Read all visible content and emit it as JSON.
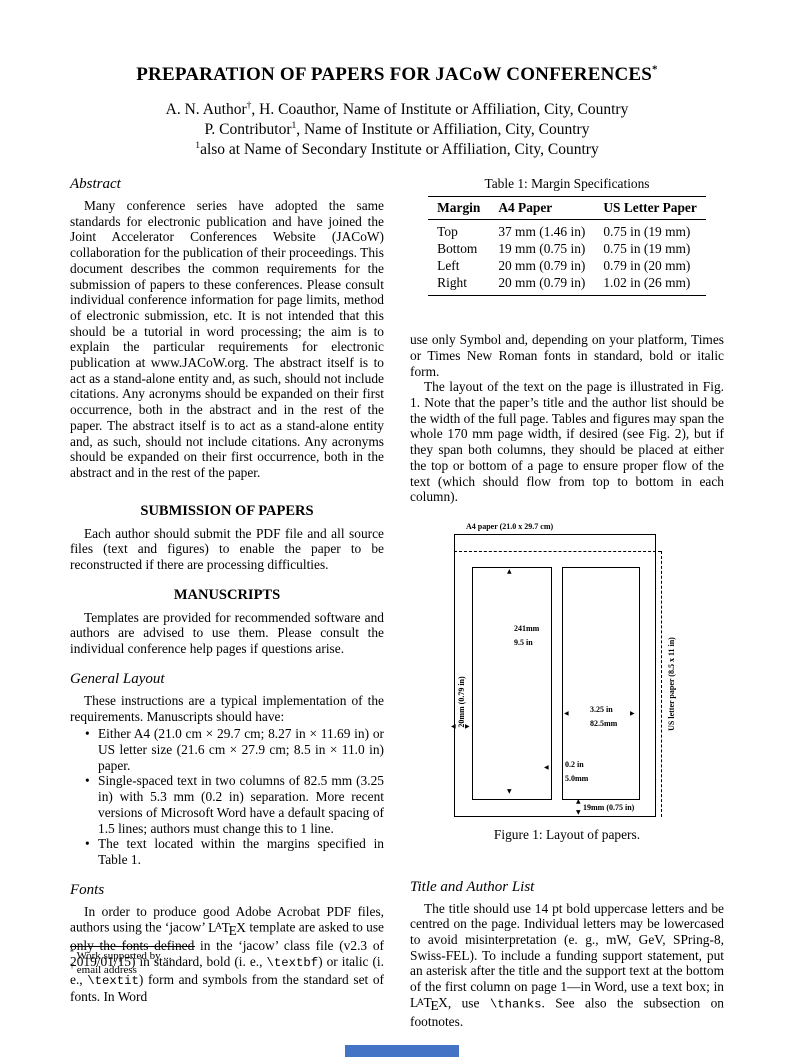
{
  "accent_color": "#4472c4",
  "header": {
    "title": "PREPARATION OF PAPERS FOR JACoW CONFERENCES",
    "title_superscript": "*",
    "authors": [
      {
        "pre": "A. N. Author",
        "sup": "†",
        "post": ", H. Coauthor, Name of Institute or Affiliation, City, Country"
      },
      {
        "pre": "P. Contributor",
        "sup": "1",
        "post": ", Name of Institute or Affiliation, City, Country"
      },
      {
        "pre": "",
        "sup": "1",
        "post": "also at Name of Secondary Institute or Affiliation, City, Country"
      }
    ]
  },
  "left_column": {
    "abstract_heading": "Abstract",
    "abstract_text": "Many conference series have adopted the same standards for electronic publication and have joined the Joint Accelerator Conferences Website (JACoW) collaboration for the publication of their proceedings. This document describes the common requirements for the submission of papers to these conferences. Please consult individual conference information for page limits, method of electronic submission, etc. It is not intended that this should be a tutorial in word processing; the aim is to explain the particular requirements for electronic publication at www.JACoW.org. The abstract itself is to act as a stand-alone entity and, as such, should not include citations. Any acronyms should be expanded on their first occurrence, both in the abstract and in the rest of the paper. The abstract itself is to act as a stand-alone entity and, as such, should not include citations. Any acronyms should be expanded on their first occurrence, both in the abstract and in the rest of the paper.",
    "submission_heading": "SUBMISSION OF PAPERS",
    "submission_text": "Each author should submit the PDF file and all source files (text and figures) to enable the paper to be reconstructed if there are processing difficulties.",
    "manuscripts_heading": "MANUSCRIPTS",
    "manuscripts_text": "Templates are provided for recommended software and authors are advised to use them. Please consult the individual conference help pages if questions arise.",
    "general_layout_heading": "General Layout",
    "general_layout_text": "These instructions are a typical implementation of the requirements. Manuscripts should have:",
    "bullets": [
      "Either A4 (21.0 cm × 29.7 cm; 8.27 in × 11.69 in) or US letter size (21.6 cm × 27.9 cm; 8.5 in × 11.0 in) paper.",
      "Single-spaced text in two columns of 82.5 mm (3.25 in) with 5.3 mm (0.2 in) separation. More recent versions of Microsoft Word have a default spacing of 1.5 lines; authors must change this to 1 line.",
      "The text located within the margins specified in Table 1."
    ],
    "fonts_heading": "Fonts",
    "fonts_paragraph": [
      {
        "t": "text",
        "v": "In order to produce good Adobe Acrobat PDF files, authors using the ‘jacow’ "
      },
      {
        "t": "latex",
        "v": "LATEX"
      },
      {
        "t": "text",
        "v": " template are asked to use only the fonts defined in the ‘jacow’ class file (v2.3 of 2019/01/15) in standard, bold (i. e., "
      },
      {
        "t": "mono",
        "v": "\\textbf"
      },
      {
        "t": "text",
        "v": ") or italic (i. e., "
      },
      {
        "t": "mono",
        "v": "\\textit"
      },
      {
        "t": "text",
        "v": ") form and symbols from the standard set of fonts. In Word"
      }
    ],
    "footnotes": [
      {
        "marker": "*",
        "text": "Work supported by ..."
      },
      {
        "marker": "†",
        "text": "email address"
      }
    ]
  },
  "right_column": {
    "table": {
      "caption": "Table 1: Margin Specifications",
      "headers": [
        "Margin",
        "A4 Paper",
        "US Letter Paper"
      ],
      "rows": [
        [
          "Top",
          "37 mm (1.46 in)",
          "0.75 in (19 mm)"
        ],
        [
          "Bottom",
          "19 mm (0.75 in)",
          "0.75 in (19 mm)"
        ],
        [
          "Left",
          "20 mm (0.79 in)",
          "0.79 in (20 mm)"
        ],
        [
          "Right",
          "20 mm (0.79 in)",
          "1.02 in (26 mm)"
        ]
      ]
    },
    "symbol_text": "use only Symbol and, depending on your platform, Times or Times New Roman fonts in standard, bold or italic form.",
    "layout_text": "The layout of the text on the page is illustrated in Fig. 1. Note that the paper’s title and the author list should be the width of the full page. Tables and figures may span the whole 170 mm page width, if desired (see Fig. 2), but if they span both columns, they should be placed at either the top or bottom of a page to ensure proper flow of the text (which should flow from top to bottom in each column).",
    "figure": {
      "a4_label": "A4 paper (21.0 x 29.7 cm)",
      "us_letter_label": "US letter paper (8.5 x 11 in)",
      "left_margin_label": "20mm (0.79 in)",
      "column_height_mm": "241mm",
      "column_height_in": "9.5 in",
      "column_width_in": "3.25 in",
      "column_width_mm": "82.5mm",
      "gap_in": "0.2 in",
      "gap_mm": "5.0mm",
      "bottom_margin_label": "19mm (0.75 in)",
      "caption": "Figure 1: Layout of papers."
    },
    "title_author_heading": "Title and Author List",
    "title_author_paragraph": [
      {
        "t": "text",
        "v": "The title should use 14 pt bold uppercase letters and be centred on the page. Individual letters may be lowercased to avoid misinterpretation (e. g., mW, GeV, SPring-8, Swiss-FEL). To include a funding support statement, put an asterisk after the title and the support text at the bottom of the first column on page 1—in Word, use a text box; in "
      },
      {
        "t": "latex",
        "v": "LATEX"
      },
      {
        "t": "text",
        "v": ", use "
      },
      {
        "t": "mono",
        "v": "\\thanks"
      },
      {
        "t": "text",
        "v": ". See also the subsection on footnotes."
      }
    ]
  }
}
